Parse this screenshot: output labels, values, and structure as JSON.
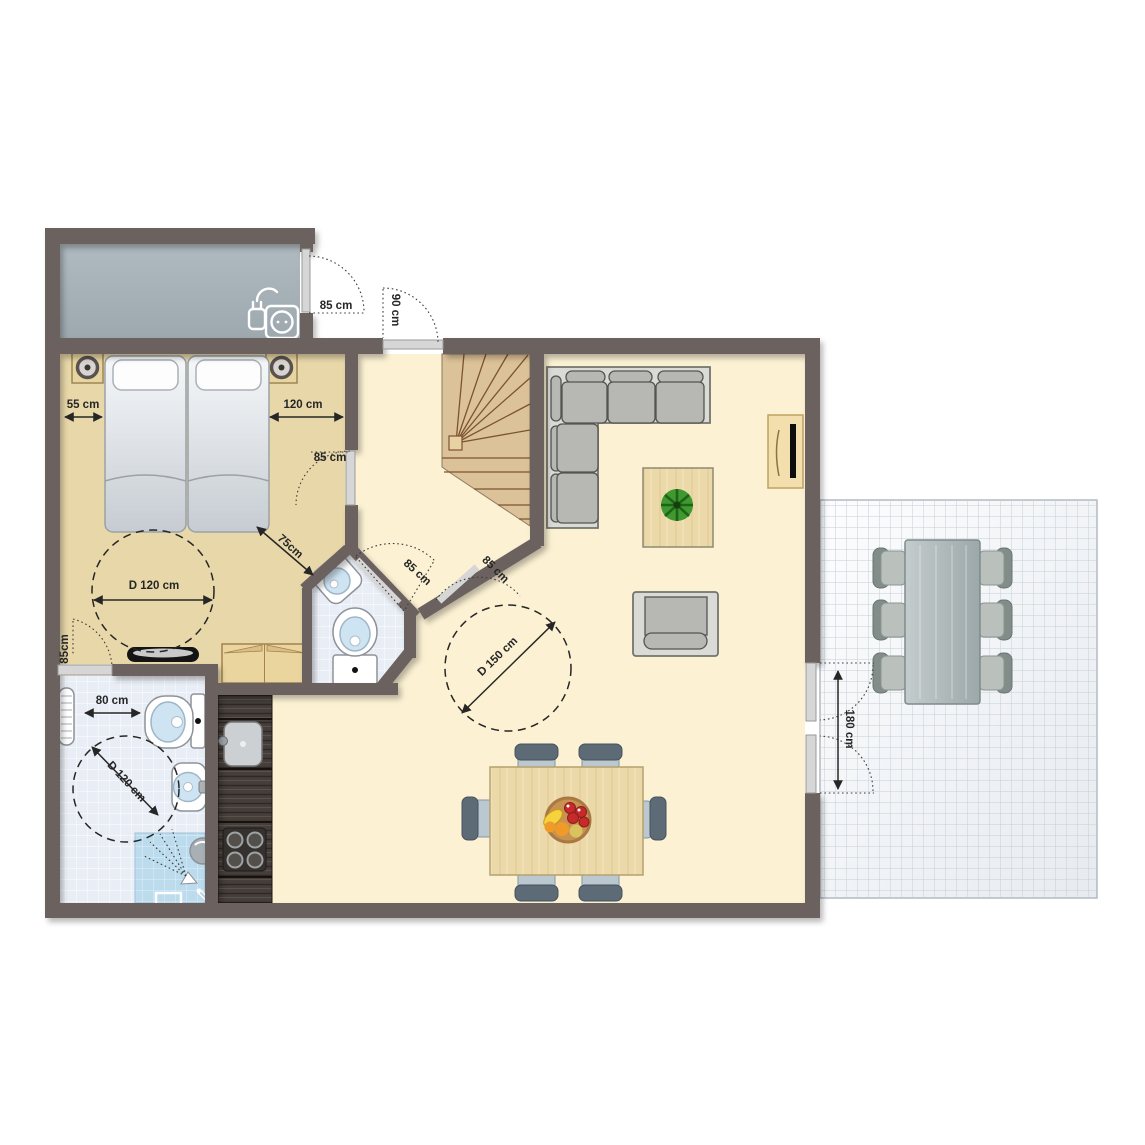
{
  "dimensions": {
    "storage_door": "85 cm",
    "entrance_door": "90 cm",
    "bed_left_clearance": "55 cm",
    "bed_right_clearance": "120 cm",
    "bedroom_door": "85 cm",
    "bed_foot_clearance": "75cm",
    "bedroom_turning_circle": "D 120 cm",
    "bedroom_bathroom_door": "85cm",
    "wc_door": "85 cm",
    "living_room_door": "85 cm",
    "toilet_clearance": "80 cm",
    "bathroom_turning_circle": "D 120 cm",
    "living_turning_circle": "D 150 cm",
    "terrace_double_door": "180 cm"
  },
  "icons": {
    "power_socket": "socket-with-plug",
    "shower": "shower-spray",
    "plant": "plant-top-view",
    "fruit_bowl": "fruit-bowl",
    "lamp": "bedside-lamp"
  },
  "palette": {
    "wall": "#6b625f",
    "bedroom_floor": "#e8d8a9",
    "living_floor": "#fcf1d3",
    "storage": "#a9b2b8",
    "stairs_wood": "#dcc298",
    "bathroom_tile": "#e9eef6",
    "shower_tile": "#bcdced",
    "kitchen_counter": "#413b37",
    "sofa_gray": "#b7b7b3",
    "chair_blue_gray": "#bcc8d0",
    "table_wood": "#ecd9a9",
    "plant_green": "#3f9930",
    "dimension_text": "#262626"
  }
}
